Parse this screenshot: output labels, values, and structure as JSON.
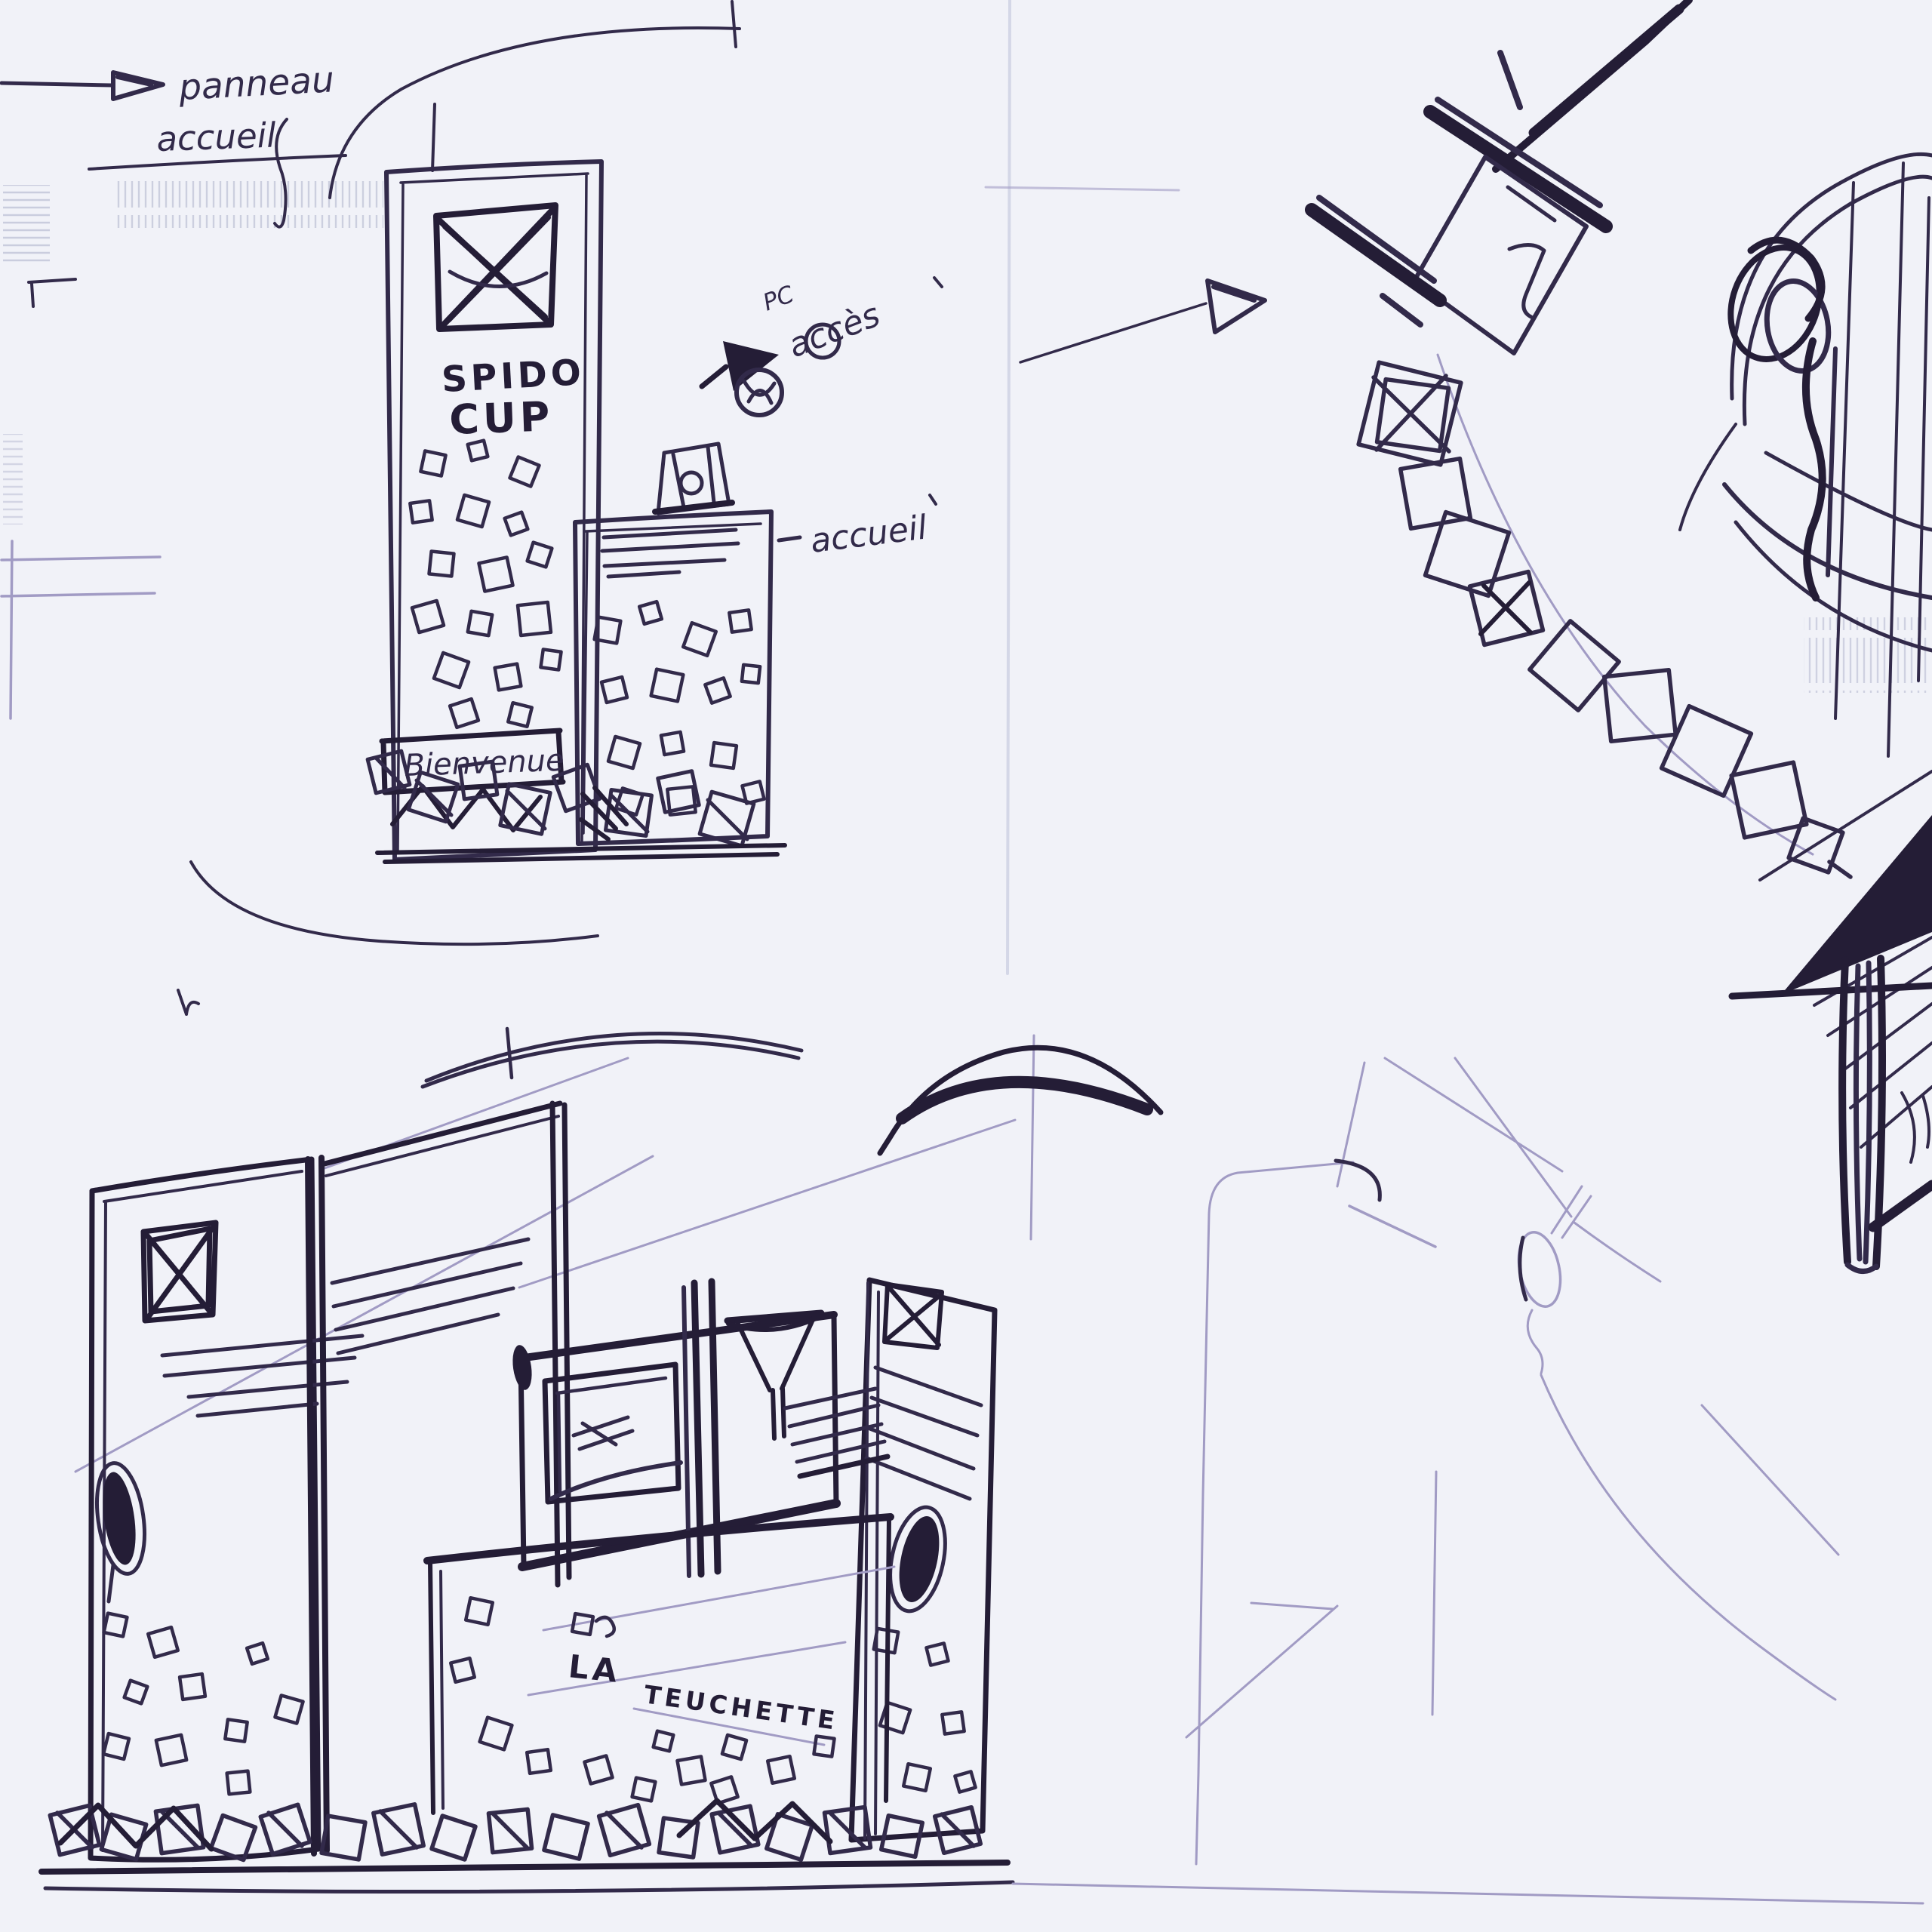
{
  "page": {
    "description": "Ballpoint-pen concept sketches of exhibition stands on scanned paper",
    "background": "#f1f2f8",
    "ink": "#322a4a",
    "ink_heavy": "#241d36",
    "pencil": "#a19bc4",
    "faint": "#cdd0e2"
  },
  "annotations": {
    "panel_note": {
      "line1": "panneau",
      "line2": "accueil"
    },
    "totem_title": {
      "line1": "SPIDO",
      "line2": "CUP"
    },
    "access_note": {
      "prefix": "PC",
      "word": "accès"
    },
    "reception_note": "accueil",
    "welcome_banner": "Bienvenue",
    "stand_label": {
      "word1": "LA",
      "word2": "TEUCHETTE"
    }
  }
}
